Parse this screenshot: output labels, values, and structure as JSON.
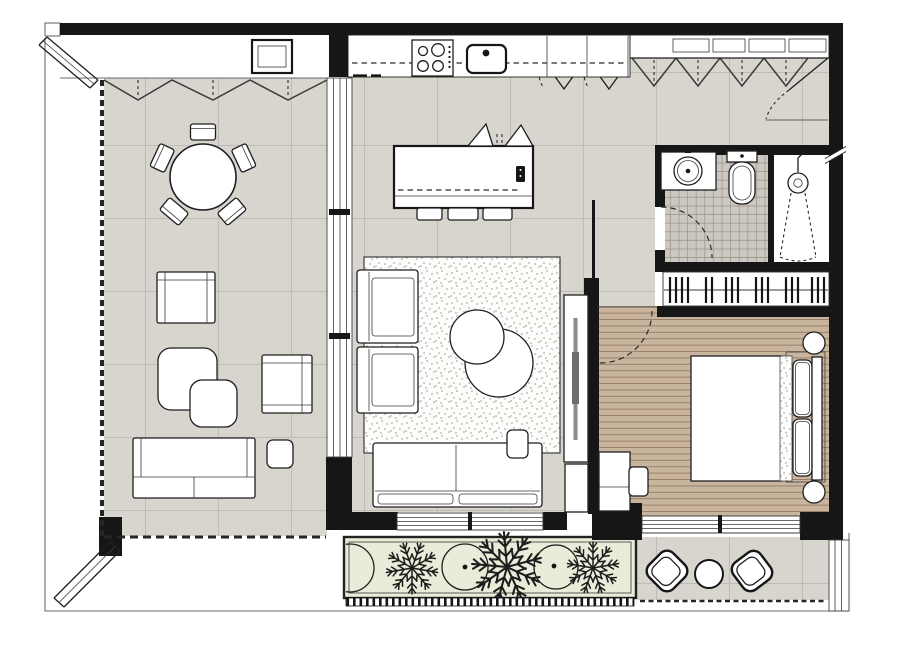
{
  "meta": {
    "title": "Apartment floor plan",
    "style": "top-down architectural drawing",
    "text_labels": []
  },
  "colors": {
    "background": "#ffffff",
    "wall": "#161616",
    "outline": "#1f1f1f",
    "tile_base": "#d8d5ce",
    "tile_line": "#bfbcb5",
    "wood_base": "#c9b49d",
    "wood_line": "#98826e",
    "bath_tile_base": "#ccc8c1",
    "bath_tile_line": "#9e998f",
    "rug_base": "#fdfdfc",
    "stipple_dot": "#b2afa9",
    "planter_fill": "#e9ecd8",
    "tv_screen": "#8a8a8a"
  },
  "rooms": [
    {
      "id": "terrace-lounge",
      "floor": "ceramic-tile"
    },
    {
      "id": "kitchen-living-room",
      "floor": "ceramic-tile"
    },
    {
      "id": "entry-hall",
      "floor": "ceramic-tile"
    },
    {
      "id": "bathroom",
      "floor": "mosaic-tile"
    },
    {
      "id": "wardrobe",
      "floor": "plain"
    },
    {
      "id": "bedroom",
      "floor": "wood-plank"
    },
    {
      "id": "bedroom-balcony",
      "floor": "ceramic-tile"
    },
    {
      "id": "planter-box",
      "floor": "planting-bed"
    }
  ],
  "furniture": {
    "terrace_lounge": [
      "round-dining-table",
      "dining-chair-x5",
      "armchair-x2",
      "nesting-coffee-table-x2",
      "bench-sofa",
      "side-table"
    ],
    "kitchen": [
      "cooktop-4-burner",
      "sink",
      "counter-run",
      "upper-cabinets-x4",
      "island",
      "bar-stool-x3",
      "pendant-lamp-x2"
    ],
    "living": [
      "rug",
      "armchair-x2",
      "round-coffee-table-x2",
      "sofa-2-seat",
      "side-table",
      "tv-console"
    ],
    "bathroom": [
      "vanity-round-basin",
      "toilet",
      "shower-head",
      "door-swing"
    ],
    "wardrobe": [
      "hanging-rail-with-hangers"
    ],
    "bedroom": [
      "double-bed",
      "pillow-x2",
      "nightstand-round-x2",
      "dresser",
      "stool",
      "door-swing"
    ],
    "bedroom_balcony": [
      "lounge-chair-x2",
      "round-table"
    ],
    "planter_box": [
      "shrub-circle-x3",
      "tree-x3"
    ]
  }
}
